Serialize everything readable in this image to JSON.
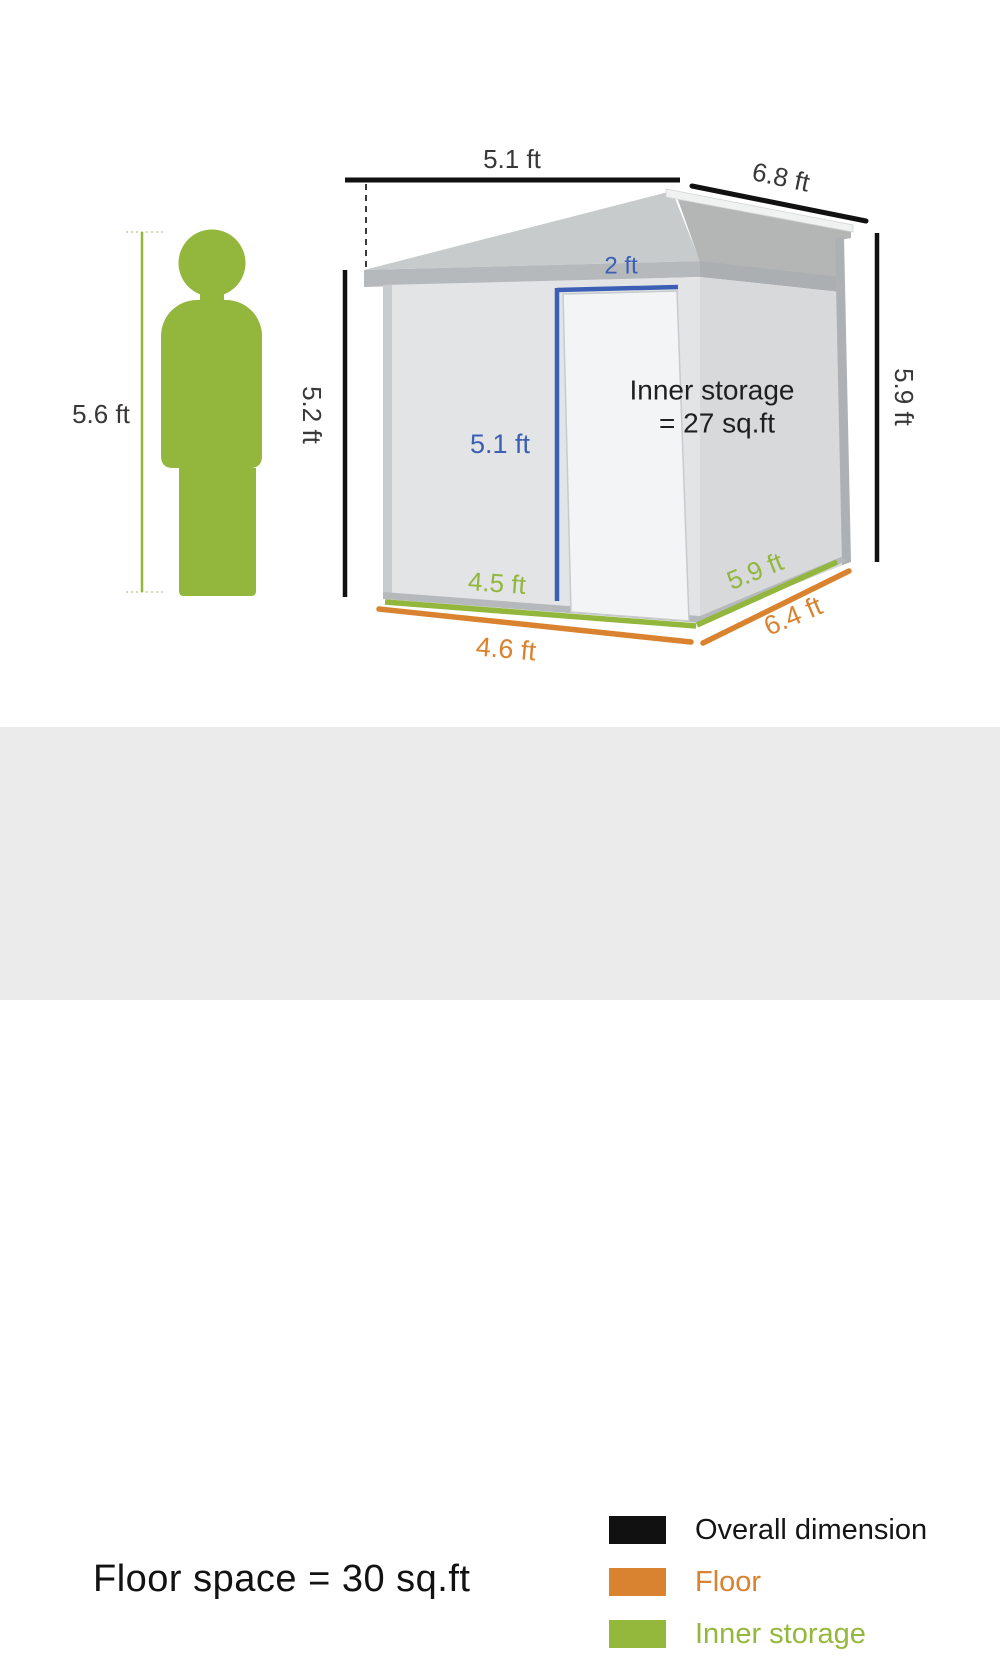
{
  "colors": {
    "overall_dimension": "#111111",
    "floor": "#d9822f",
    "inner_storage": "#94b83c",
    "door_dimension_blue": "#3a5fb5",
    "footer_background": "#ebebeb",
    "roof_gray": "#c8cbcb",
    "front_wall_gray": "#e3e4e6",
    "right_wall_gray": "#d7d9da"
  },
  "person": {
    "height": "5.6 ft"
  },
  "shed": {
    "overall": {
      "width": "5.1 ft",
      "depth": "6.8 ft",
      "front_height": "5.2 ft",
      "back_height": "5.9 ft"
    },
    "door": {
      "width": "2 ft",
      "height": "5.1 ft"
    },
    "inner_storage": {
      "front": "4.5 ft",
      "side": "5.9 ft",
      "note_line1": "Inner storage",
      "note_line2": "= 27 sq.ft"
    },
    "floor": {
      "front": "4.6 ft",
      "side": "6.4 ft"
    }
  },
  "footer": {
    "floor_space": "Floor space = 30 sq.ft",
    "legend": [
      {
        "label": "Overall dimension",
        "color": "#111111"
      },
      {
        "label": "Floor",
        "color": "#d9822f"
      },
      {
        "label": "Inner storage",
        "color": "#94b83c"
      }
    ]
  }
}
